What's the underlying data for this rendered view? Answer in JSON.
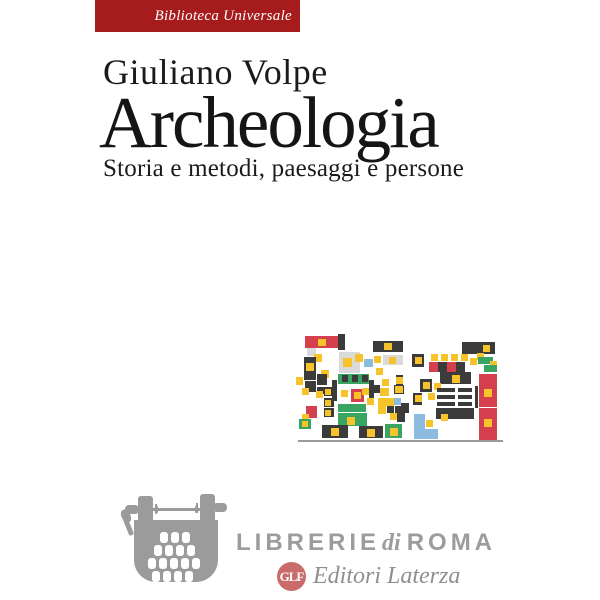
{
  "cover": {
    "series_banner": {
      "label": "Biblioteca Universale",
      "bg": "#a61c1c",
      "text_color": "#ffffff"
    },
    "author": "Giuliano Volpe",
    "title": "Archeologia",
    "subtitle": "Storia e metodi, paesaggi e persone"
  },
  "footer": {
    "bookstore": {
      "word1": "LIBRERIE",
      "word2": "di",
      "word3": "ROMA",
      "text_color": "#9c9c9c"
    },
    "publisher": {
      "monogram": "GLF",
      "name": "Editori Laterza",
      "logo_color": "#c96b6b",
      "text_color": "#8f8f8f"
    },
    "icons": {
      "typewriter": "typewriter-icon",
      "monogram": "glf-monogram"
    }
  },
  "artwork": {
    "description": "abstract-excavation-plan-mosaic",
    "palette": {
      "K": "#3b3b3b",
      "R": "#d4404e",
      "G": "#3aa563",
      "Y": "#f6c32b",
      "B": "#8cbbdf",
      "L": "#dadada",
      "H": "#9a9a9a"
    },
    "blocks": [
      {
        "x": 9,
        "y": 6,
        "w": 33,
        "h": 12,
        "c": "R"
      },
      {
        "x": 42,
        "y": 4,
        "w": 7,
        "h": 16,
        "c": "K"
      },
      {
        "x": 22,
        "y": 9,
        "w": 8,
        "h": 7,
        "c": "Y"
      },
      {
        "x": 77,
        "y": 11,
        "w": 30,
        "h": 11,
        "c": "K"
      },
      {
        "x": 88,
        "y": 13,
        "w": 8,
        "h": 7,
        "c": "Y"
      },
      {
        "x": 166,
        "y": 12,
        "w": 33,
        "h": 12,
        "c": "K"
      },
      {
        "x": 187,
        "y": 15,
        "w": 7,
        "h": 7,
        "c": "Y"
      },
      {
        "x": 11,
        "y": 18,
        "w": 9,
        "h": 8,
        "c": "L"
      },
      {
        "x": 18,
        "y": 24,
        "w": 8,
        "h": 8,
        "c": "Y"
      },
      {
        "x": 8,
        "y": 27,
        "w": 12,
        "h": 23,
        "c": "K"
      },
      {
        "x": 10,
        "y": 33,
        "w": 8,
        "h": 8,
        "c": "Y"
      },
      {
        "x": 25,
        "y": 40,
        "w": 8,
        "h": 8,
        "c": "Y"
      },
      {
        "x": 21,
        "y": 44,
        "w": 10,
        "h": 11,
        "c": "K"
      },
      {
        "x": 0,
        "y": 47,
        "w": 7,
        "h": 8,
        "c": "Y"
      },
      {
        "x": 9,
        "y": 51,
        "w": 11,
        "h": 11,
        "c": "K"
      },
      {
        "x": 6,
        "y": 58,
        "w": 7,
        "h": 7,
        "c": "Y"
      },
      {
        "x": 21,
        "y": 57,
        "w": 9,
        "h": 7,
        "c": "K"
      },
      {
        "x": 43,
        "y": 22,
        "w": 21,
        "h": 21,
        "c": "L"
      },
      {
        "x": 47,
        "y": 28,
        "w": 9,
        "h": 9,
        "c": "Y"
      },
      {
        "x": 59,
        "y": 24,
        "w": 8,
        "h": 8,
        "c": "Y"
      },
      {
        "x": 68,
        "y": 29,
        "w": 9,
        "h": 8,
        "c": "B"
      },
      {
        "x": 78,
        "y": 26,
        "w": 7,
        "h": 7,
        "c": "Y"
      },
      {
        "x": 87,
        "y": 25,
        "w": 20,
        "h": 10,
        "c": "L"
      },
      {
        "x": 93,
        "y": 27,
        "w": 7,
        "h": 7,
        "c": "Y"
      },
      {
        "x": 116,
        "y": 24,
        "w": 12,
        "h": 13,
        "c": "K"
      },
      {
        "x": 119,
        "y": 27,
        "w": 7,
        "h": 7,
        "c": "Y"
      },
      {
        "x": 135,
        "y": 24,
        "w": 7,
        "h": 7,
        "c": "Y"
      },
      {
        "x": 145,
        "y": 24,
        "w": 7,
        "h": 7,
        "c": "Y"
      },
      {
        "x": 155,
        "y": 24,
        "w": 7,
        "h": 7,
        "c": "Y"
      },
      {
        "x": 165,
        "y": 24,
        "w": 7,
        "h": 7,
        "c": "Y"
      },
      {
        "x": 133,
        "y": 32,
        "w": 9,
        "h": 10,
        "c": "R"
      },
      {
        "x": 142,
        "y": 32,
        "w": 9,
        "h": 10,
        "c": "K"
      },
      {
        "x": 151,
        "y": 32,
        "w": 9,
        "h": 10,
        "c": "R"
      },
      {
        "x": 160,
        "y": 32,
        "w": 9,
        "h": 10,
        "c": "K"
      },
      {
        "x": 174,
        "y": 28,
        "w": 7,
        "h": 7,
        "c": "Y"
      },
      {
        "x": 181,
        "y": 23,
        "w": 7,
        "h": 7,
        "c": "Y"
      },
      {
        "x": 182,
        "y": 27,
        "w": 15,
        "h": 7,
        "c": "G"
      },
      {
        "x": 194,
        "y": 31,
        "w": 7,
        "h": 7,
        "c": "Y"
      },
      {
        "x": 188,
        "y": 35,
        "w": 13,
        "h": 7,
        "c": "G"
      },
      {
        "x": 42,
        "y": 44,
        "w": 31,
        "h": 10,
        "c": "G"
      },
      {
        "x": 46,
        "y": 45,
        "w": 6,
        "h": 7,
        "c": "K"
      },
      {
        "x": 56,
        "y": 45,
        "w": 6,
        "h": 7,
        "c": "K"
      },
      {
        "x": 66,
        "y": 45,
        "w": 6,
        "h": 7,
        "c": "K"
      },
      {
        "x": 36,
        "y": 50,
        "w": 5,
        "h": 21,
        "c": "K"
      },
      {
        "x": 73,
        "y": 50,
        "w": 5,
        "h": 20,
        "c": "K"
      },
      {
        "x": 80,
        "y": 38,
        "w": 7,
        "h": 7,
        "c": "Y"
      },
      {
        "x": 86,
        "y": 49,
        "w": 7,
        "h": 7,
        "c": "Y"
      },
      {
        "x": 100,
        "y": 45,
        "w": 7,
        "h": 19,
        "c": "K"
      },
      {
        "x": 100,
        "y": 47,
        "w": 7,
        "h": 7,
        "c": "Y"
      },
      {
        "x": 124,
        "y": 49,
        "w": 12,
        "h": 13,
        "c": "K"
      },
      {
        "x": 127,
        "y": 52,
        "w": 7,
        "h": 7,
        "c": "Y"
      },
      {
        "x": 144,
        "y": 42,
        "w": 31,
        "h": 12,
        "c": "K"
      },
      {
        "x": 156,
        "y": 45,
        "w": 8,
        "h": 8,
        "c": "Y"
      },
      {
        "x": 138,
        "y": 53,
        "w": 7,
        "h": 7,
        "c": "Y"
      },
      {
        "x": 183,
        "y": 44,
        "w": 18,
        "h": 33,
        "c": "R"
      },
      {
        "x": 188,
        "y": 59,
        "w": 8,
        "h": 8,
        "c": "Y"
      },
      {
        "x": 28,
        "y": 57,
        "w": 10,
        "h": 9,
        "c": "K"
      },
      {
        "x": 29,
        "y": 59,
        "w": 6,
        "h": 6,
        "c": "Y"
      },
      {
        "x": 28,
        "y": 68,
        "w": 10,
        "h": 9,
        "c": "K"
      },
      {
        "x": 29,
        "y": 70,
        "w": 6,
        "h": 6,
        "c": "Y"
      },
      {
        "x": 28,
        "y": 78,
        "w": 10,
        "h": 9,
        "c": "K"
      },
      {
        "x": 29,
        "y": 80,
        "w": 6,
        "h": 6,
        "c": "Y"
      },
      {
        "x": 20,
        "y": 61,
        "w": 7,
        "h": 7,
        "c": "Y"
      },
      {
        "x": 45,
        "y": 60,
        "w": 7,
        "h": 7,
        "c": "Y"
      },
      {
        "x": 55,
        "y": 59,
        "w": 13,
        "h": 13,
        "c": "R"
      },
      {
        "x": 58,
        "y": 62,
        "w": 7,
        "h": 7,
        "c": "Y"
      },
      {
        "x": 42,
        "y": 74,
        "w": 28,
        "h": 8,
        "c": "G"
      },
      {
        "x": 66,
        "y": 58,
        "w": 7,
        "h": 7,
        "c": "Y"
      },
      {
        "x": 71,
        "y": 68,
        "w": 7,
        "h": 7,
        "c": "Y"
      },
      {
        "x": 78,
        "y": 55,
        "w": 6,
        "h": 8,
        "c": "K"
      },
      {
        "x": 84,
        "y": 58,
        "w": 9,
        "h": 8,
        "c": "Y"
      },
      {
        "x": 98,
        "y": 55,
        "w": 10,
        "h": 9,
        "c": "K"
      },
      {
        "x": 99,
        "y": 56,
        "w": 8,
        "h": 7,
        "c": "Y"
      },
      {
        "x": 82,
        "y": 68,
        "w": 8,
        "h": 8,
        "c": "Y"
      },
      {
        "x": 90,
        "y": 68,
        "w": 8,
        "h": 8,
        "c": "Y"
      },
      {
        "x": 98,
        "y": 68,
        "w": 7,
        "h": 7,
        "c": "B"
      },
      {
        "x": 82,
        "y": 76,
        "w": 8,
        "h": 8,
        "c": "Y"
      },
      {
        "x": 91,
        "y": 76,
        "w": 7,
        "h": 7,
        "c": "K"
      },
      {
        "x": 99,
        "y": 76,
        "w": 7,
        "h": 7,
        "c": "K"
      },
      {
        "x": 105,
        "y": 73,
        "w": 8,
        "h": 10,
        "c": "K"
      },
      {
        "x": 117,
        "y": 63,
        "w": 9,
        "h": 12,
        "c": "K"
      },
      {
        "x": 119,
        "y": 65,
        "w": 7,
        "h": 7,
        "c": "Y"
      },
      {
        "x": 141,
        "y": 58,
        "w": 18,
        "h": 4,
        "c": "K"
      },
      {
        "x": 162,
        "y": 58,
        "w": 14,
        "h": 4,
        "c": "K"
      },
      {
        "x": 141,
        "y": 65,
        "w": 18,
        "h": 4,
        "c": "K"
      },
      {
        "x": 162,
        "y": 65,
        "w": 14,
        "h": 4,
        "c": "K"
      },
      {
        "x": 141,
        "y": 72,
        "w": 18,
        "h": 4,
        "c": "K"
      },
      {
        "x": 162,
        "y": 72,
        "w": 14,
        "h": 4,
        "c": "K"
      },
      {
        "x": 179,
        "y": 56,
        "w": 3,
        "h": 22,
        "c": "K"
      },
      {
        "x": 132,
        "y": 63,
        "w": 7,
        "h": 7,
        "c": "Y"
      },
      {
        "x": 140,
        "y": 78,
        "w": 38,
        "h": 11,
        "c": "K"
      },
      {
        "x": 145,
        "y": 84,
        "w": 7,
        "h": 7,
        "c": "Y"
      },
      {
        "x": 10,
        "y": 76,
        "w": 11,
        "h": 12,
        "c": "R"
      },
      {
        "x": 6,
        "y": 84,
        "w": 7,
        "h": 7,
        "c": "Y"
      },
      {
        "x": 3,
        "y": 89,
        "w": 12,
        "h": 10,
        "c": "G"
      },
      {
        "x": 6,
        "y": 91,
        "w": 6,
        "h": 6,
        "c": "Y"
      },
      {
        "x": 42,
        "y": 83,
        "w": 29,
        "h": 13,
        "c": "G"
      },
      {
        "x": 51,
        "y": 87,
        "w": 8,
        "h": 8,
        "c": "Y"
      },
      {
        "x": 101,
        "y": 79,
        "w": 8,
        "h": 13,
        "c": "K"
      },
      {
        "x": 94,
        "y": 83,
        "w": 7,
        "h": 7,
        "c": "Y"
      },
      {
        "x": 118,
        "y": 84,
        "w": 11,
        "h": 25,
        "c": "B"
      },
      {
        "x": 118,
        "y": 99,
        "w": 24,
        "h": 10,
        "c": "B"
      },
      {
        "x": 130,
        "y": 90,
        "w": 7,
        "h": 7,
        "c": "Y"
      },
      {
        "x": 183,
        "y": 78,
        "w": 18,
        "h": 32,
        "c": "R"
      },
      {
        "x": 188,
        "y": 89,
        "w": 8,
        "h": 8,
        "c": "Y"
      },
      {
        "x": 26,
        "y": 95,
        "w": 26,
        "h": 13,
        "c": "K"
      },
      {
        "x": 35,
        "y": 98,
        "w": 8,
        "h": 8,
        "c": "Y"
      },
      {
        "x": 63,
        "y": 96,
        "w": 24,
        "h": 12,
        "c": "K"
      },
      {
        "x": 71,
        "y": 99,
        "w": 8,
        "h": 8,
        "c": "Y"
      },
      {
        "x": 89,
        "y": 94,
        "w": 17,
        "h": 14,
        "c": "G"
      },
      {
        "x": 94,
        "y": 98,
        "w": 8,
        "h": 8,
        "c": "Y"
      },
      {
        "x": 2,
        "y": 110,
        "w": 205,
        "h": 2,
        "c": "H"
      }
    ]
  }
}
